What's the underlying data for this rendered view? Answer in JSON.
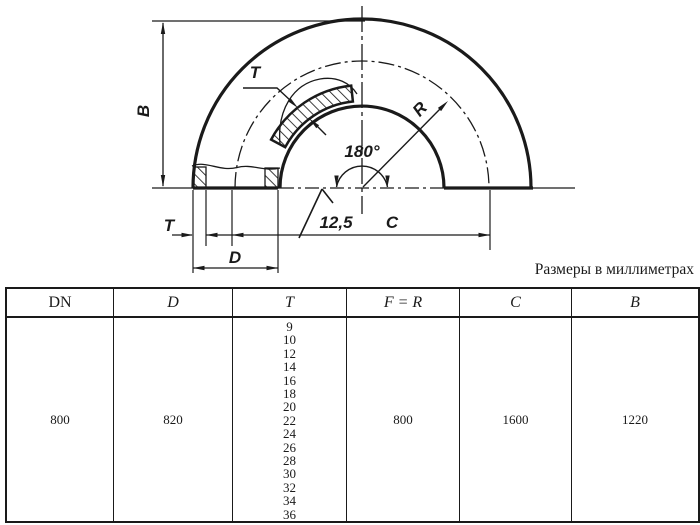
{
  "meta": {
    "ink": "#1a1a1a",
    "paper": "#ffffff"
  },
  "caption": "Размеры в миллиметрах",
  "drawing": {
    "labels": {
      "height_b": "B",
      "wall_top": "T",
      "radius_r": "R",
      "angle": "180°",
      "roughness": "12,5",
      "wall_bottom": "T",
      "center_distance_c": "C",
      "diameter_d": "D"
    }
  },
  "table": {
    "headers": [
      "DN",
      "D",
      "T",
      "F = R",
      "C",
      "B"
    ],
    "row": {
      "dn": "800",
      "d": "820",
      "t_values": [
        "9",
        "10",
        "12",
        "14",
        "16",
        "18",
        "20",
        "22",
        "24",
        "26",
        "28",
        "30",
        "32",
        "34",
        "36"
      ],
      "f_eq_r": "800",
      "c": "1600",
      "b": "1220"
    }
  }
}
